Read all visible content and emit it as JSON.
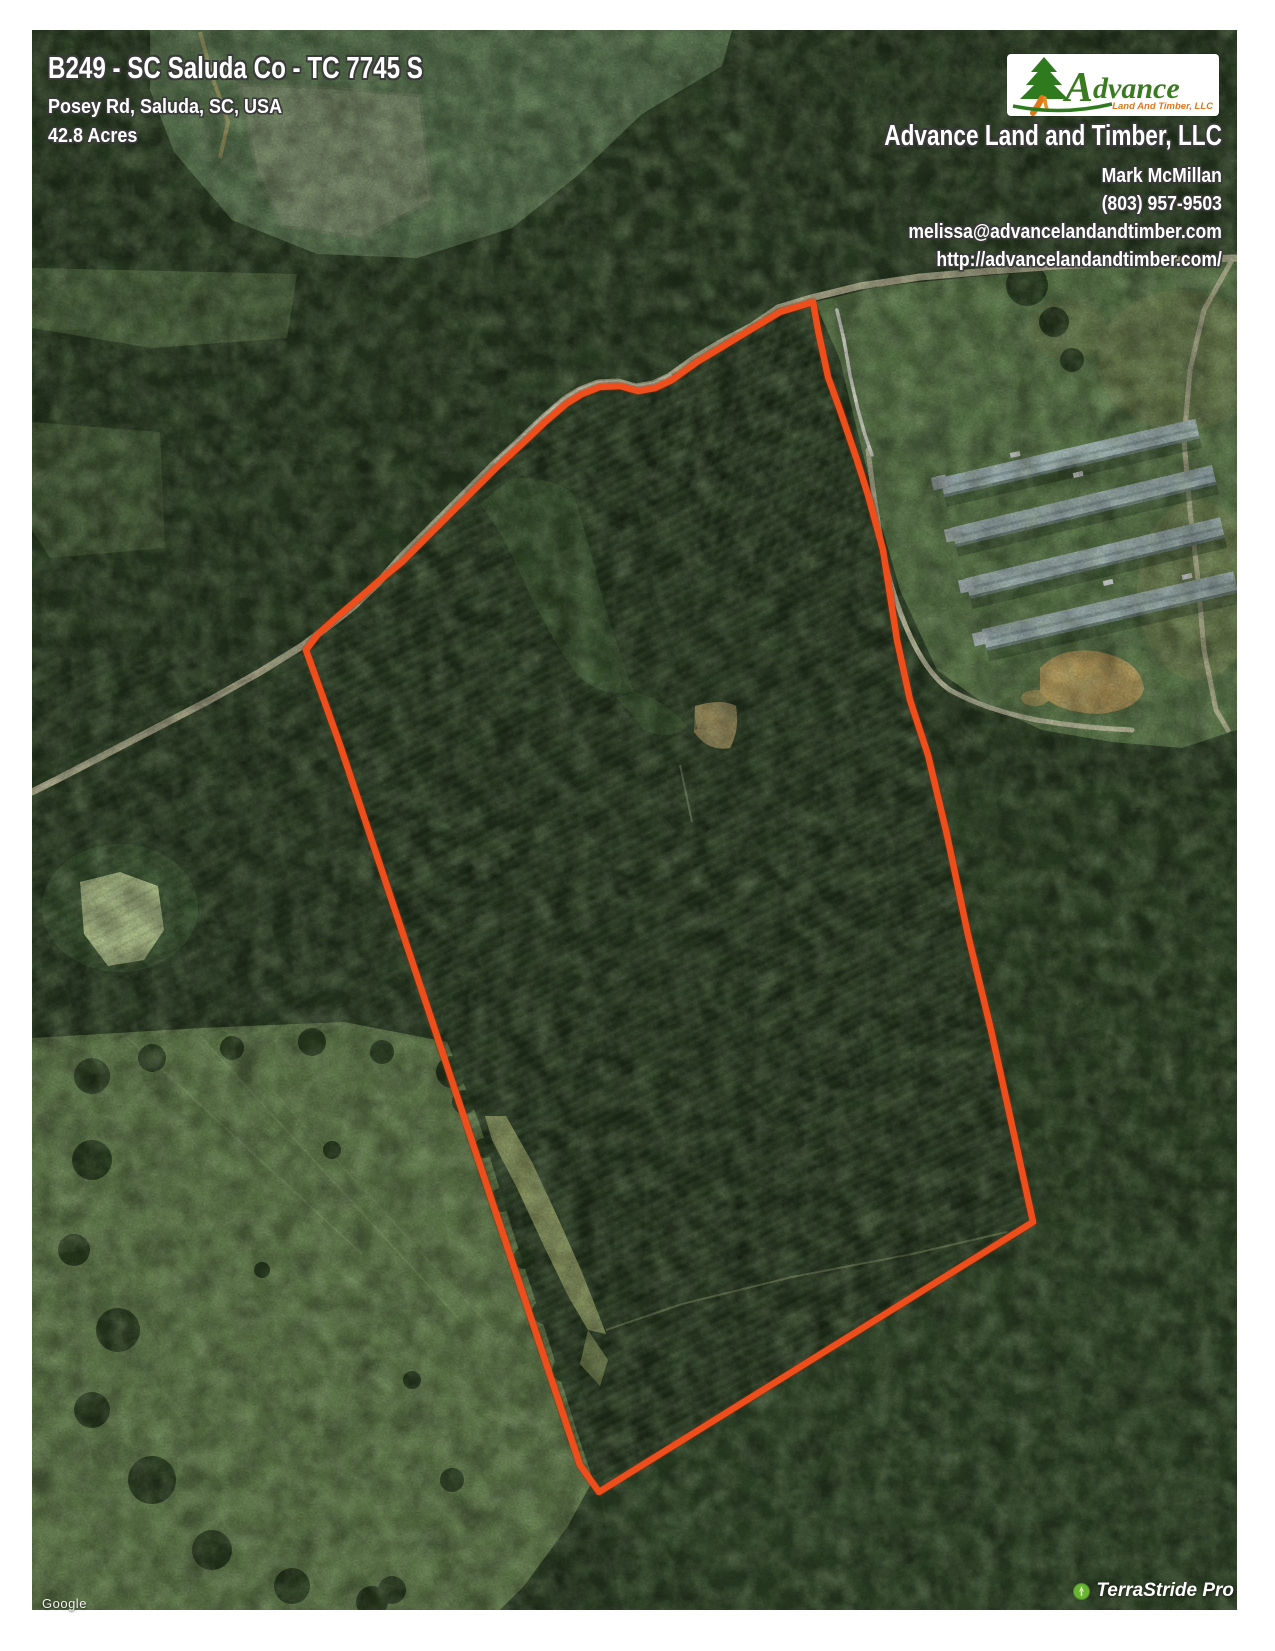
{
  "header": {
    "title": "B249 - SC Saluda Co - TC 7745 S",
    "address": "Posey Rd, Saluda, SC, USA",
    "acreage": "42.8 Acres"
  },
  "branding": {
    "logo": {
      "word_initial": "A",
      "word_rest": "dvance",
      "tagline": "Land And Timber, LLC",
      "green": "#3a7a21",
      "orange": "#e0761a"
    },
    "company": "Advance Land and Timber, LLC",
    "agent": "Mark McMillan",
    "phone": "(803) 957-9503",
    "email": "melissa@advancelandandtimber.com",
    "website": "http://advancelandandtimber.com/"
  },
  "watermarks": {
    "imagery_credit": "Google",
    "app_badge": "TerraStride Pro"
  },
  "map_overlay": {
    "boundary_color": "#ee4e1c"
  }
}
